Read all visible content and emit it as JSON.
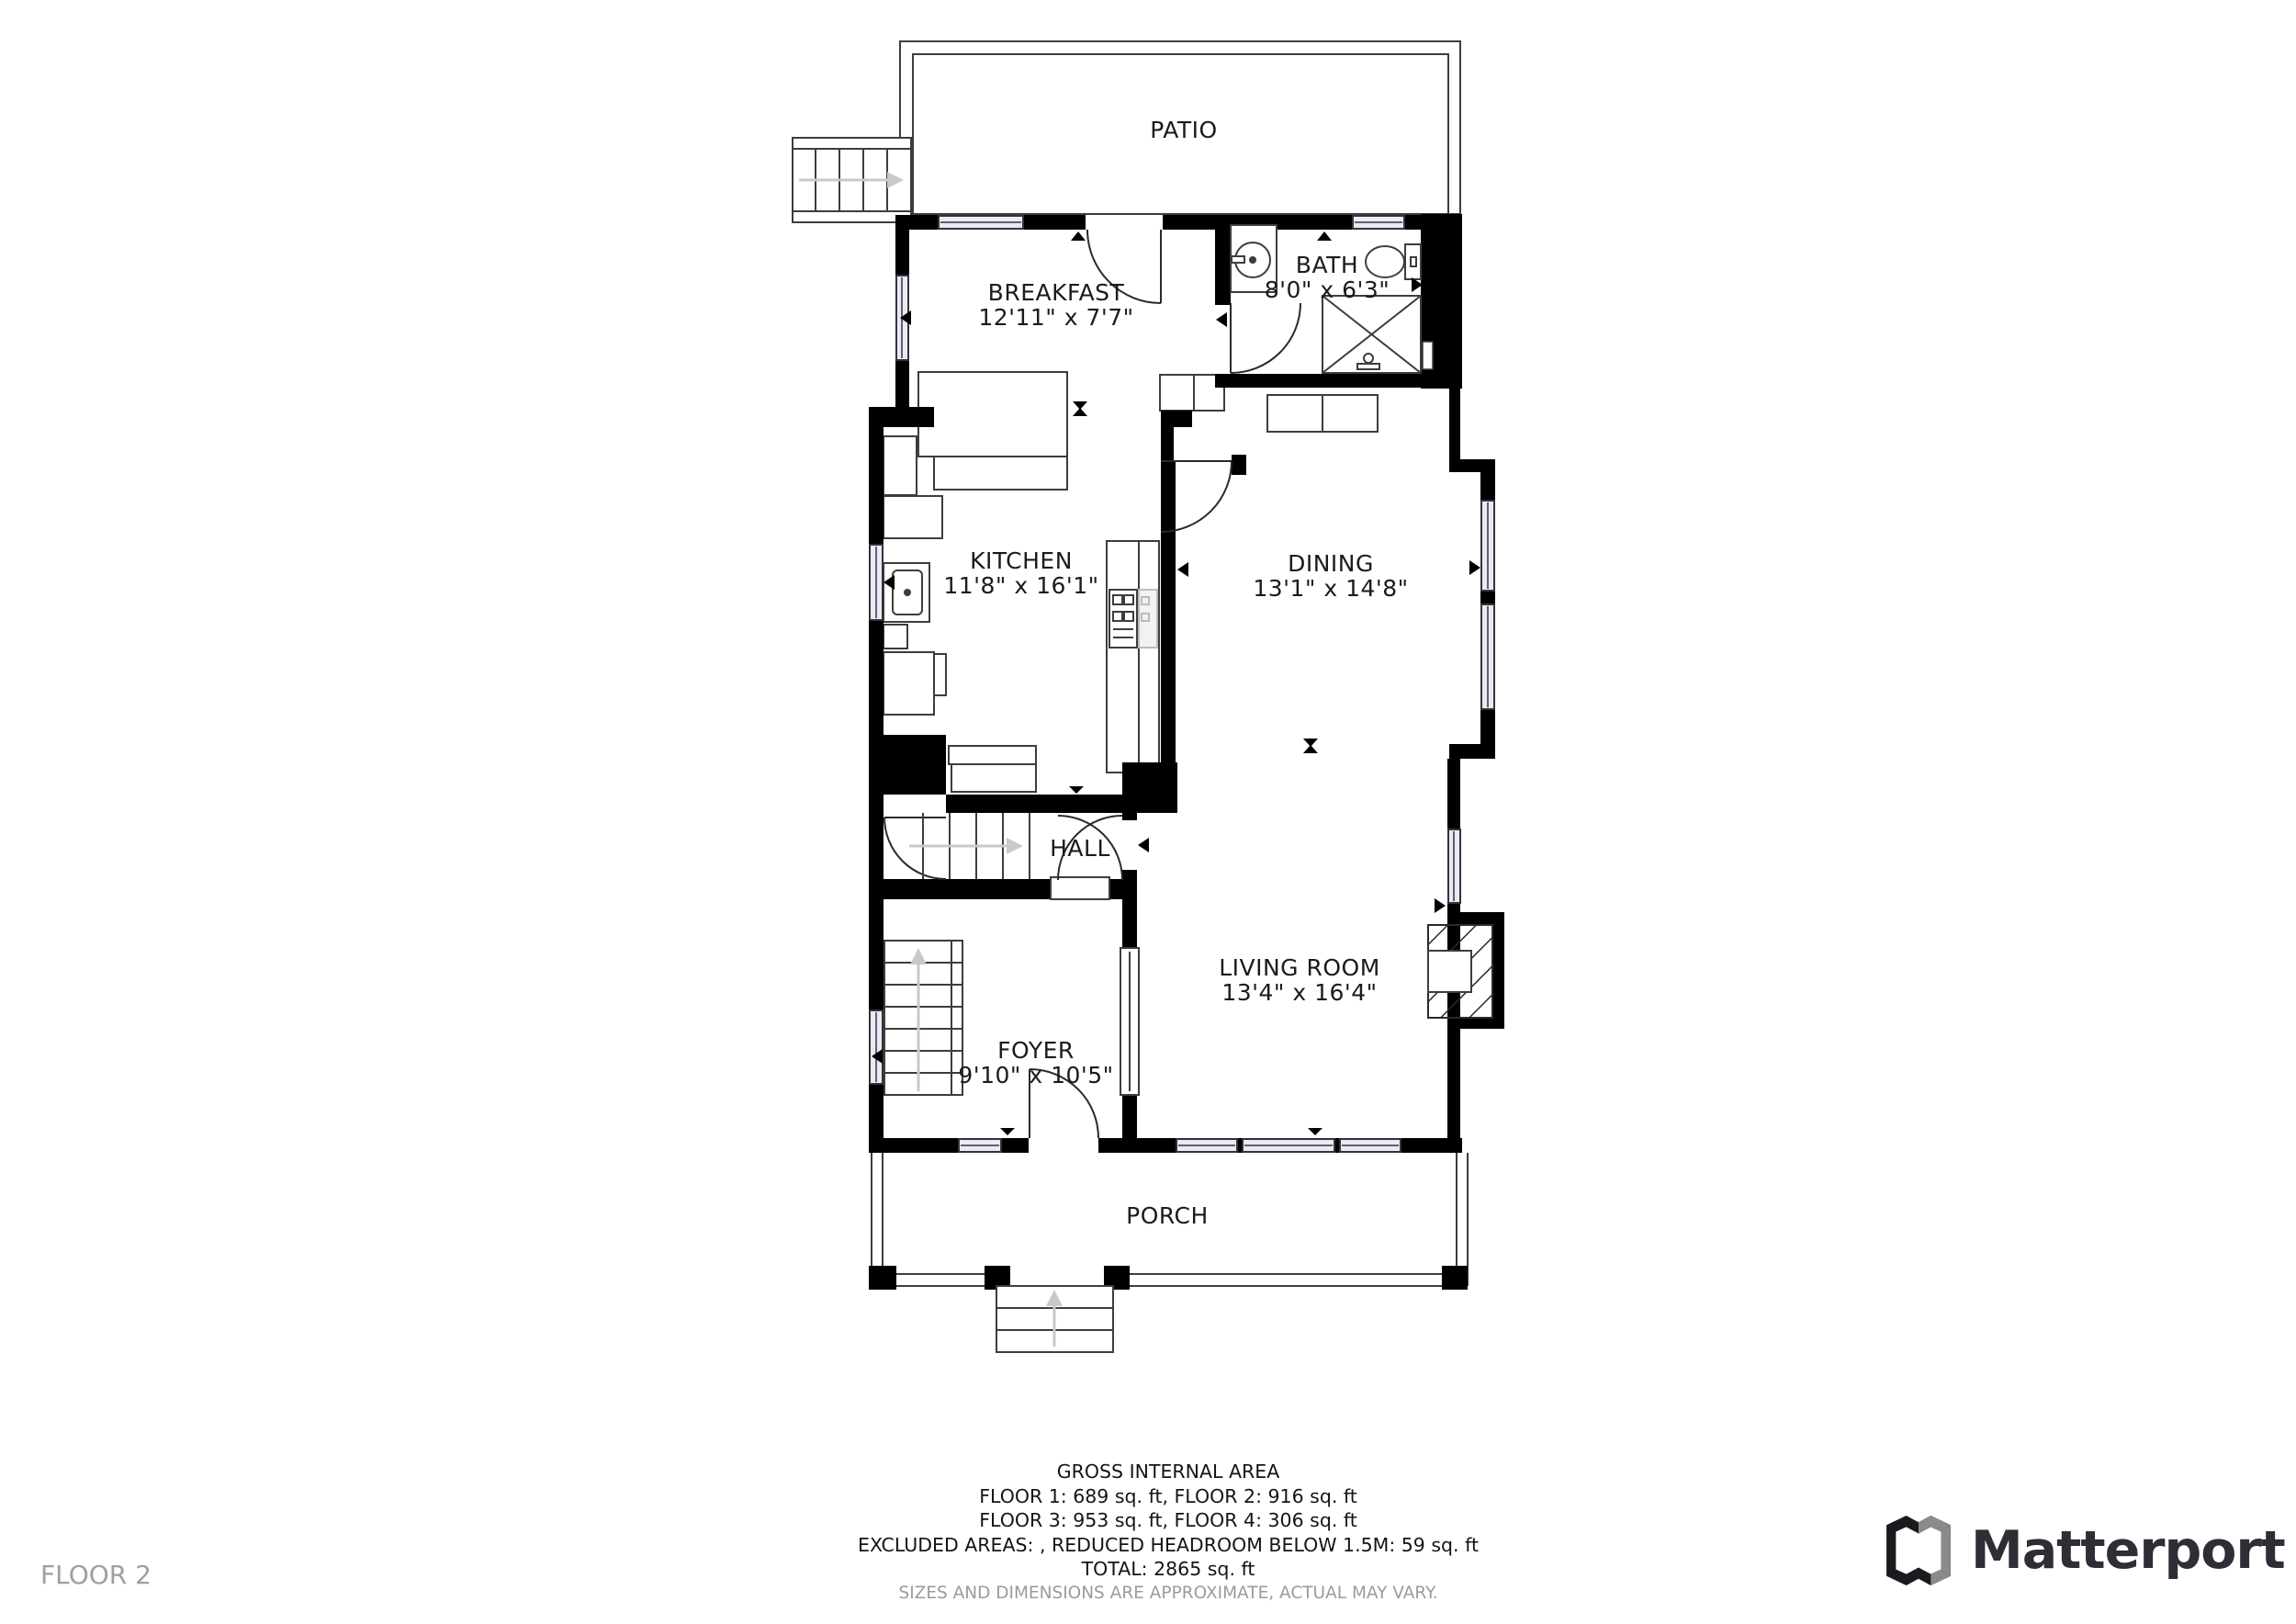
{
  "floor_label": "FLOOR 2",
  "brand": {
    "wordmark": "Matterport"
  },
  "rooms": {
    "patio": {
      "name": "PATIO"
    },
    "breakfast": {
      "name": "BREAKFAST",
      "dims": "12'11\" x 7'7\""
    },
    "bath": {
      "name": "BATH",
      "dims": "8'0\" x 6'3\""
    },
    "kitchen": {
      "name": "KITCHEN",
      "dims": "11'8\" x 16'1\""
    },
    "dining": {
      "name": "DINING",
      "dims": "13'1\" x 14'8\""
    },
    "hall": {
      "name": "HALL"
    },
    "foyer": {
      "name": "FOYER",
      "dims": "9'10\" x 10'5\""
    },
    "living_room": {
      "name": "LIVING ROOM",
      "dims": "13'4\" x 16'4\""
    },
    "porch": {
      "name": "PORCH"
    }
  },
  "footer": {
    "title": "GROSS INTERNAL AREA",
    "line_floors_1_2": "FLOOR 1: 689 sq. ft, FLOOR 2: 916 sq. ft",
    "line_floors_3_4": "FLOOR 3: 953 sq. ft, FLOOR 4: 306 sq. ft",
    "line_excluded": "EXCLUDED AREAS: , REDUCED HEADROOM BELOW 1.5M: 59 sq. ft",
    "line_total": "TOTAL: 2865 sq. ft",
    "disclaimer": "SIZES AND DIMENSIONS ARE APPROXIMATE, ACTUAL MAY VARY."
  },
  "colors": {
    "walls": "#000000",
    "window_fill": "#e9eaf5",
    "muted_text": "#9b9b9b",
    "floor_label_text": "#9aa0a4",
    "logo_text": "#2e2e36",
    "logo_gray_facet": "#8a8a8a"
  }
}
